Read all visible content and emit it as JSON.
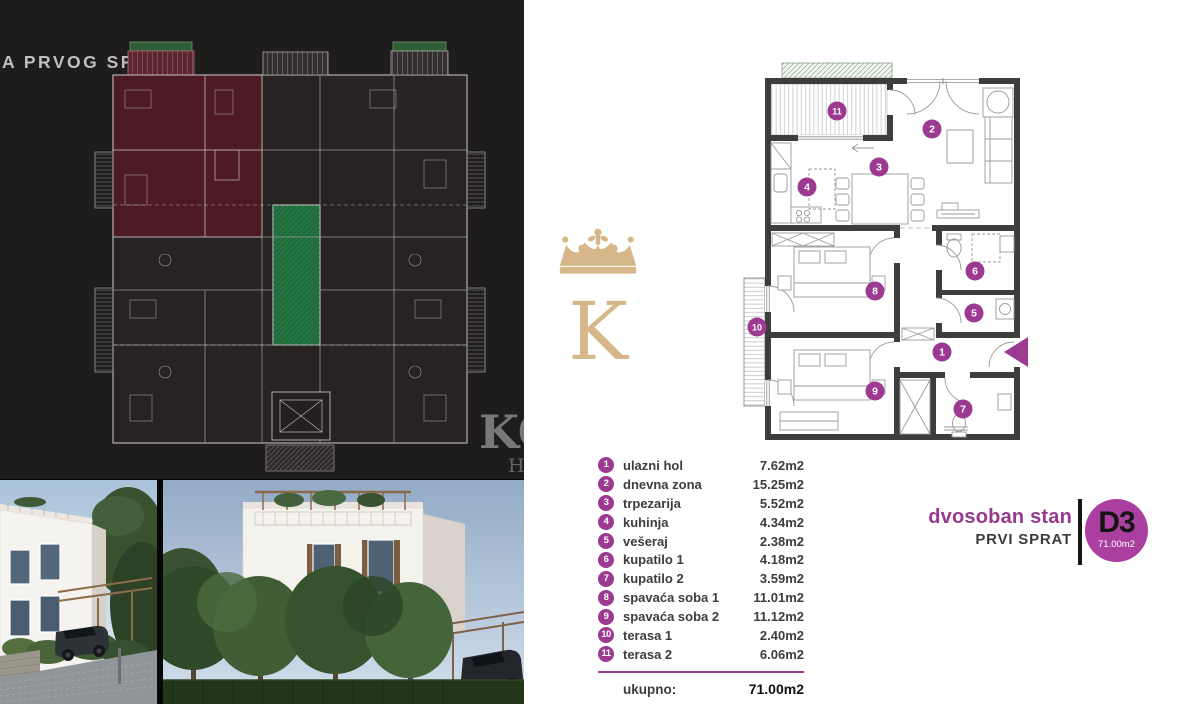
{
  "left_panel": {
    "title": "A PRVOG SPRATA",
    "watermark_line1": "KO",
    "watermark_line2": "H"
  },
  "logo": {
    "letter": "K"
  },
  "plan": {
    "markers": [
      "1",
      "2",
      "3",
      "4",
      "5",
      "6",
      "7",
      "8",
      "9",
      "10",
      "11"
    ]
  },
  "legend": {
    "items": [
      {
        "num": "1",
        "label": "ulazni hol",
        "area": "7.62m2"
      },
      {
        "num": "2",
        "label": "dnevna zona",
        "area": "15.25m2"
      },
      {
        "num": "3",
        "label": "trpezarija",
        "area": "5.52m2"
      },
      {
        "num": "4",
        "label": "kuhinja",
        "area": "4.34m2"
      },
      {
        "num": "5",
        "label": "vešeraj",
        "area": "2.38m2"
      },
      {
        "num": "6",
        "label": "kupatilo 1",
        "area": "4.18m2"
      },
      {
        "num": "7",
        "label": "kupatilo 2",
        "area": "3.59m2"
      },
      {
        "num": "8",
        "label": "spavaća soba 1",
        "area": "11.01m2"
      },
      {
        "num": "9",
        "label": "spavaća soba 2",
        "area": "11.12m2"
      },
      {
        "num": "10",
        "label": "terasa 1",
        "area": "2.40m2"
      },
      {
        "num": "11",
        "label": "terasa 2",
        "area": "6.06m2"
      }
    ],
    "total_label": "ukupno:",
    "total_value": "71.00m2"
  },
  "title_block": {
    "apartment_type": "dvosoban stan",
    "floor": "PRVI SPRAT",
    "unit_id": "D3",
    "unit_area": "71.00m2"
  },
  "colors": {
    "accent_purple": "#9c3a92",
    "badge_purple": "#ab3f9f",
    "gold": "#d5b789",
    "highlight_red": "#4f1b22",
    "courtyard_green": "#1e6b3b"
  }
}
